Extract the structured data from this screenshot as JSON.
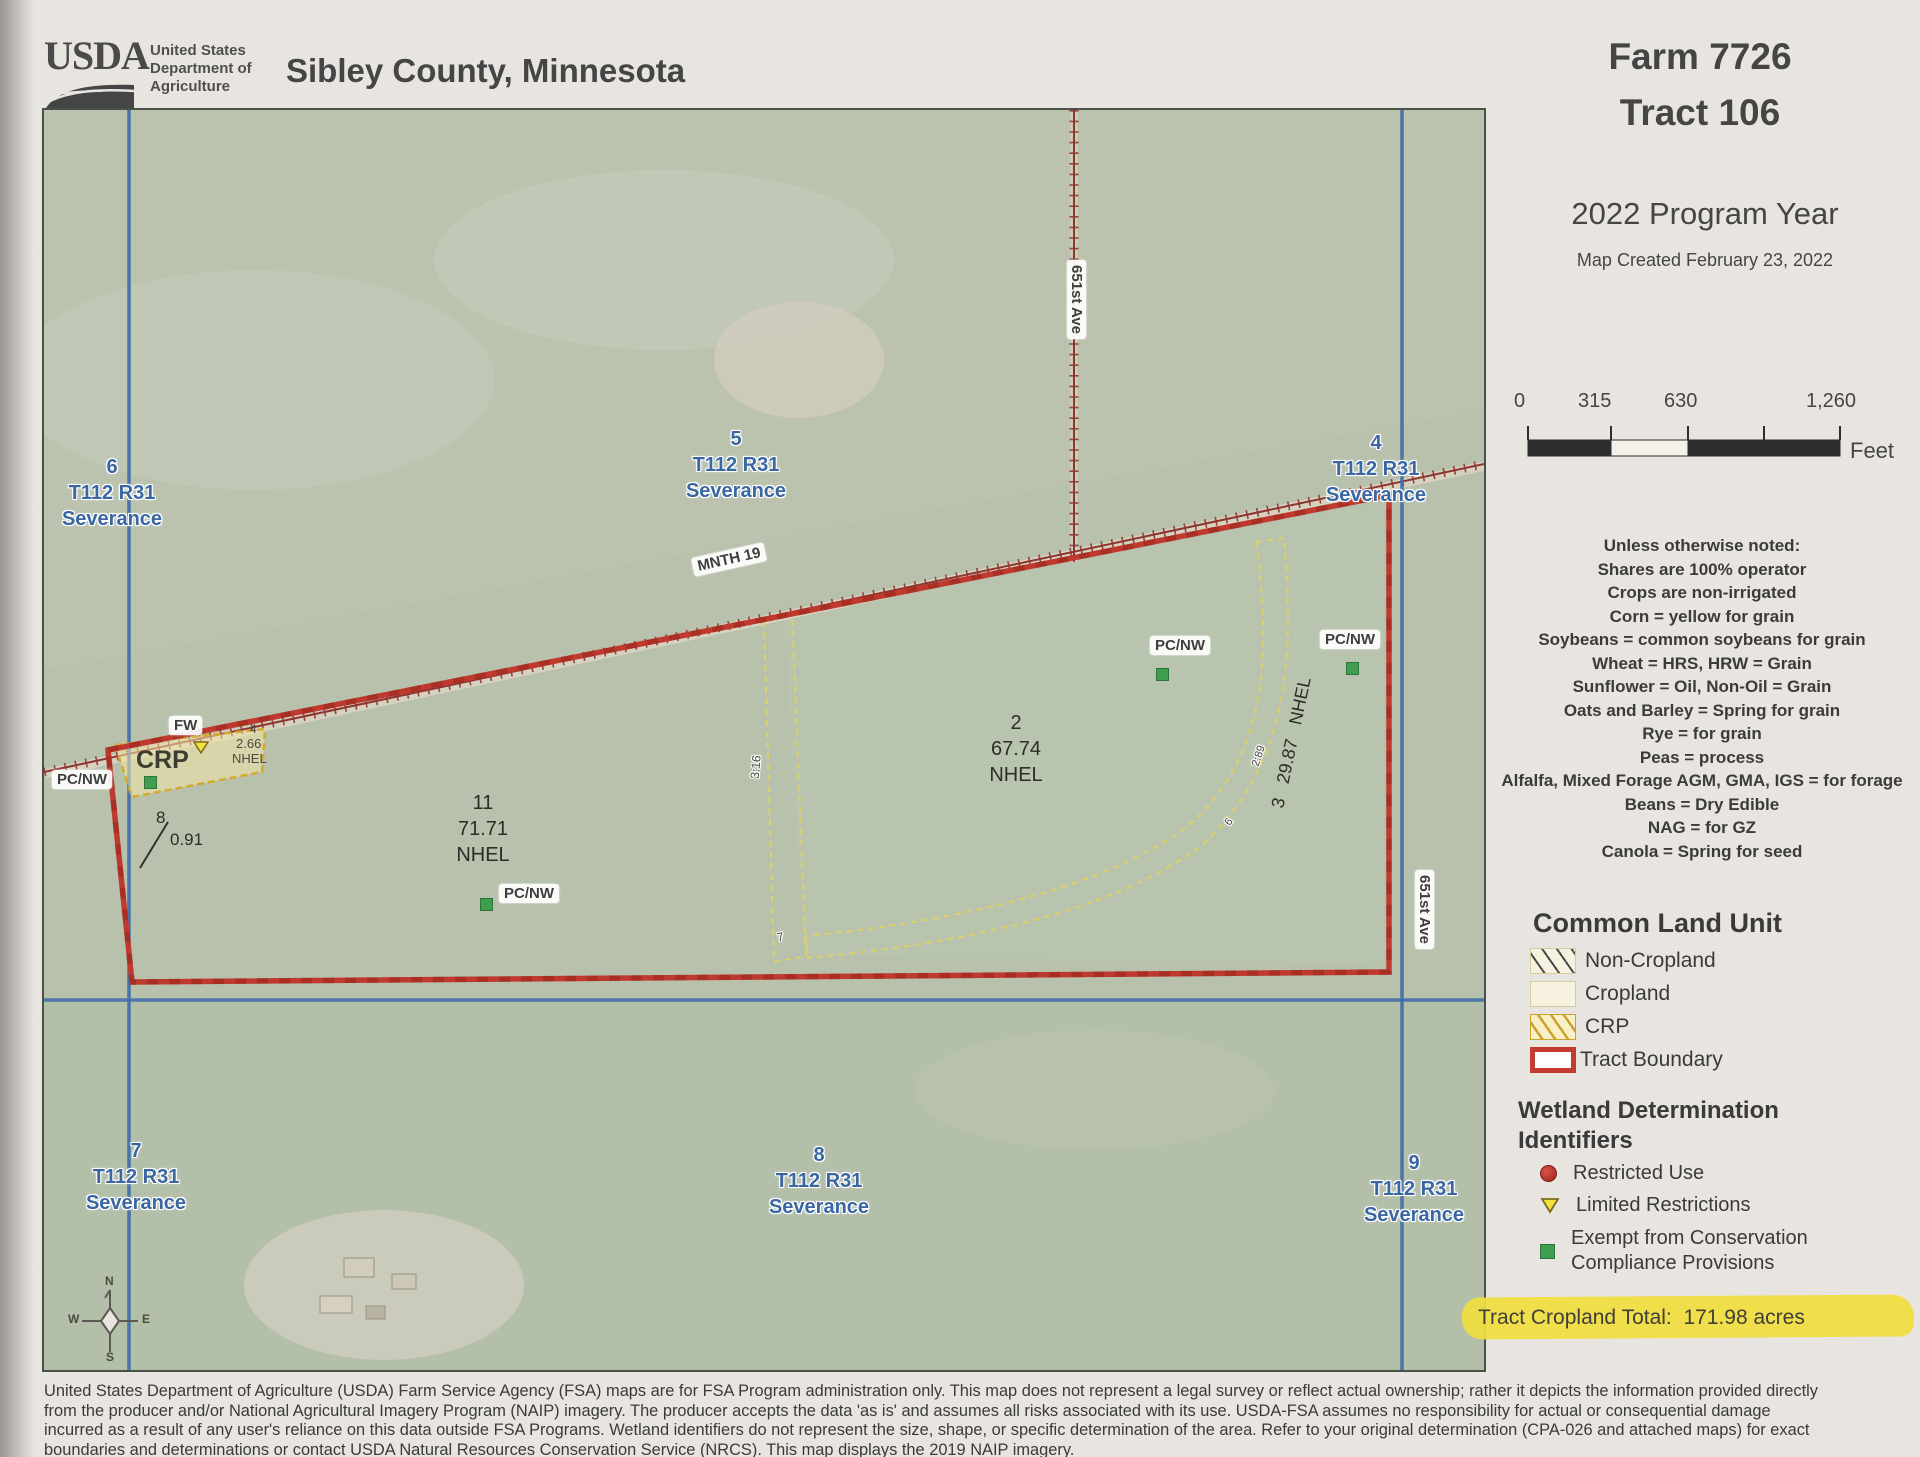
{
  "header": {
    "usda_wordmark": "USDA",
    "dept_line1": "United States",
    "dept_line2": "Department of",
    "dept_line3": "Agriculture",
    "title": "Sibley County, Minnesota",
    "farm": "Farm 7726",
    "tract": "Tract 106",
    "program_year": "2022 Program Year",
    "map_created": "Map Created February 23, 2022"
  },
  "scalebar": {
    "tick0": "0",
    "tick1": "315",
    "tick2": "630",
    "tick3": "1,260",
    "unit": "Feet"
  },
  "notes": {
    "lines": [
      "Unless otherwise noted:",
      "Shares are 100% operator",
      "Crops are non-irrigated",
      "Corn = yellow for grain",
      "Soybeans = common soybeans for grain",
      "Wheat = HRS, HRW = Grain",
      "Sunflower = Oil, Non-Oil = Grain",
      "Oats and Barley = Spring for grain",
      "Rye = for grain",
      "Peas = process",
      "Alfalfa, Mixed Forage AGM, GMA, IGS = for forage",
      "Beans = Dry Edible",
      "NAG = for GZ",
      "Canola = Spring for seed"
    ]
  },
  "clu_legend": {
    "title": "Common Land Unit",
    "non_cropland": "Non-Cropland",
    "cropland": "Cropland",
    "crp": "CRP",
    "tract_boundary": "Tract Boundary"
  },
  "wetland_legend": {
    "title_line1": "Wetland Determination",
    "title_line2": "Identifiers",
    "restricted": "Restricted Use",
    "limited": "Limited Restrictions",
    "exempt_line1": "Exempt from Conservation",
    "exempt_line2": "Compliance Provisions"
  },
  "tract_total": {
    "label": "Tract Cropland Total:",
    "value": "171.98 acres"
  },
  "map": {
    "sections": [
      {
        "num": "6",
        "township": "T112 R31",
        "name": "Severance"
      },
      {
        "num": "5",
        "township": "T112 R31",
        "name": "Severance"
      },
      {
        "num": "4",
        "township": "T112 R31",
        "name": "Severance"
      },
      {
        "num": "7",
        "township": "T112 R31",
        "name": "Severance"
      },
      {
        "num": "8",
        "township": "T112 R31",
        "name": "Severance"
      },
      {
        "num": "9",
        "township": "T112 R31",
        "name": "Severance"
      }
    ],
    "roads": {
      "highway": "MNTH 19",
      "avenue": "651st Ave"
    },
    "fields": {
      "f2": {
        "num": "2",
        "acres": "67.74",
        "hel": "NHEL"
      },
      "f11": {
        "num": "11",
        "acres": "71.71",
        "hel": "NHEL"
      },
      "f3": {
        "num": "3",
        "acres": "29.87",
        "hel": "NHEL"
      },
      "f4": {
        "num": "4",
        "acres": "2.66",
        "hel": "NHEL"
      },
      "f8": {
        "num": "8",
        "acres": "0.91"
      }
    },
    "labels": {
      "crp": "CRP",
      "fw": "FW",
      "pcnw": "PC/NW",
      "strip_mid": "3:16",
      "strip_mid_num": "7",
      "strip_right": "2:89",
      "strip_right_num": "6"
    },
    "compass": {
      "n": "N",
      "e": "E",
      "s": "S",
      "w": "W"
    }
  },
  "colors": {
    "paper": "#e8e5e0",
    "map_green": "#b7c1ac",
    "road_blue": "#4470a8",
    "tract_boundary_red": "#c0392e",
    "road_dark_red": "#8e3530",
    "crp_gold": "#d2ac2e",
    "highlight_yellow": "#f0dd3e",
    "section_label_blue": "#3a66a2",
    "wetland_restricted_red": "#9c2318",
    "wetland_limited_yellow": "#f3e13c",
    "wetland_exempt_green": "#3f9e4f"
  },
  "disclaimer": {
    "lines": [
      "United States Department of Agriculture (USDA) Farm Service Agency (FSA) maps are for FSA Program administration only.  This map does not represent a legal survey or reflect actual ownership; rather it depicts the information provided directly",
      "from the producer and/or National Agricultural Imagery Program (NAIP) imagery.  The producer accepts the data 'as is' and assumes all risks associated with its use.  USDA-FSA assumes no responsibility for actual or consequential damage",
      "incurred as a result of any user's reliance on this data outside FSA Programs.  Wetland identifiers do not represent the size, shape, or specific determination of the area.  Refer to your original determination (CPA-026 and attached maps) for exact",
      "boundaries and determinations or contact USDA Natural Resources Conservation Service (NRCS).  This map displays the 2019 NAIP imagery."
    ]
  }
}
